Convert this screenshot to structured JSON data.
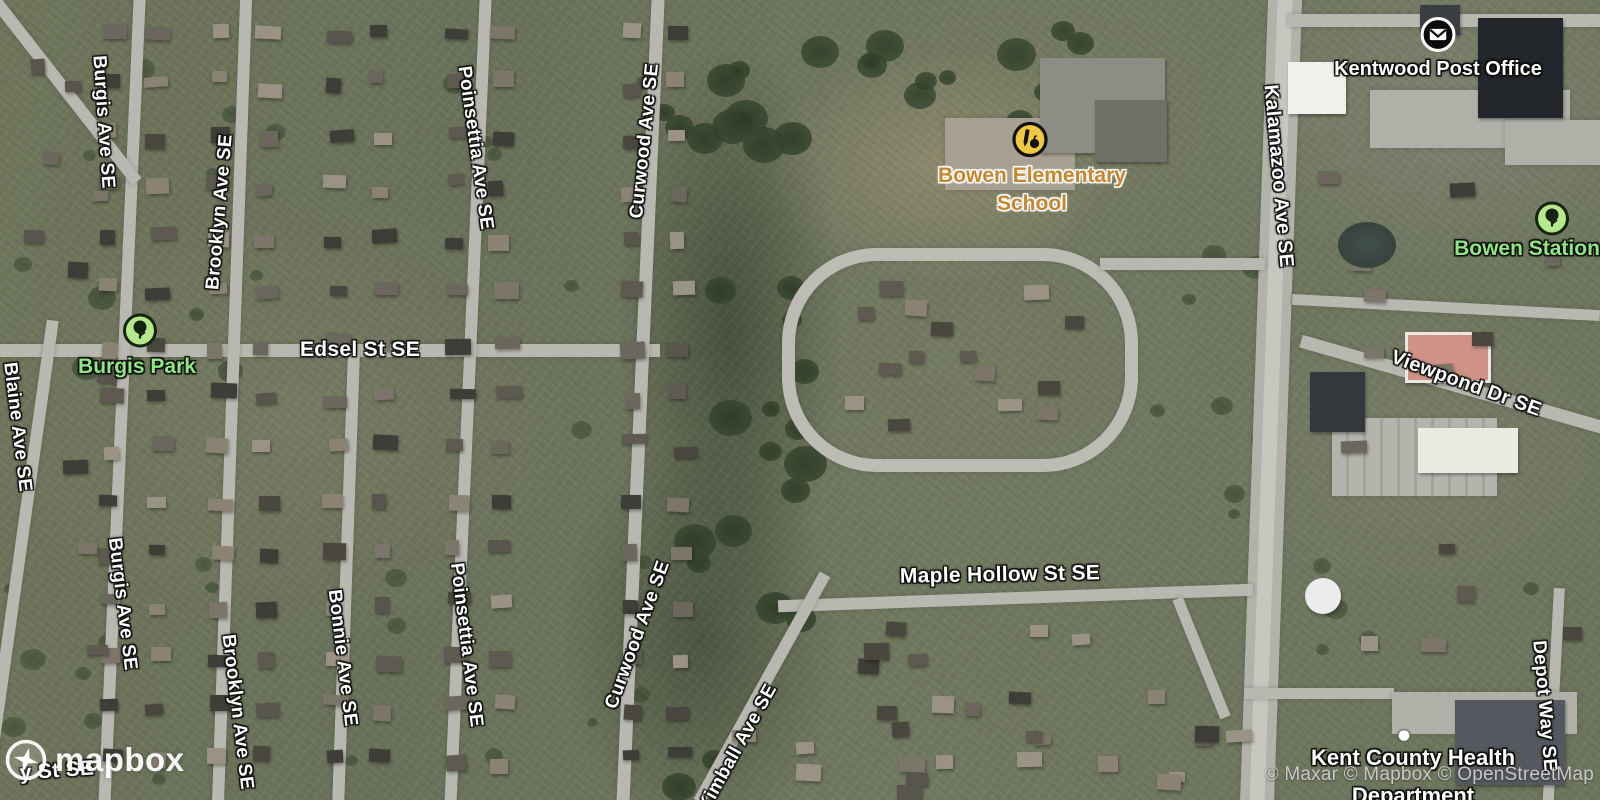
{
  "map": {
    "attribution": "© Maxar © Mapbox © OpenStreetMap",
    "logo_text": "mapbox",
    "colors": {
      "street_label": "#ffffff",
      "park_label": "#8fe683",
      "school_label": "#c6862f",
      "poi_label": "#ffffff",
      "attribution": "#c9c9c9"
    },
    "street_labels": [
      {
        "text": "Burgis Ave SE",
        "x": 103,
        "y": 122,
        "rot": 86,
        "size": 19
      },
      {
        "text": "Brooklyn Ave SE",
        "x": 220,
        "y": 212,
        "rot": -85,
        "size": 19
      },
      {
        "text": "Poinsettia Ave SE",
        "x": 475,
        "y": 148,
        "rot": 82,
        "size": 19
      },
      {
        "text": "Curwood Ave SE",
        "x": 645,
        "y": 141,
        "rot": -84,
        "size": 19
      },
      {
        "text": "Kalamazoo Ave SE",
        "x": 1278,
        "y": 176,
        "rot": 85,
        "size": 20
      },
      {
        "text": "Blaine Ave SE",
        "x": 17,
        "y": 427,
        "rot": 83,
        "size": 19
      },
      {
        "text": "Edsel St SE",
        "x": 360,
        "y": 350,
        "rot": 0,
        "size": 21
      },
      {
        "text": "Burgis Ave SE",
        "x": 122,
        "y": 604,
        "rot": 83,
        "size": 19
      },
      {
        "text": "Brooklyn Ave SE",
        "x": 237,
        "y": 712,
        "rot": 83,
        "size": 19
      },
      {
        "text": "Bonnie Ave SE",
        "x": 342,
        "y": 658,
        "rot": 83,
        "size": 19
      },
      {
        "text": "Poinsettia Ave SE",
        "x": 466,
        "y": 645,
        "rot": 83,
        "size": 19
      },
      {
        "text": "Curwood Ave SE",
        "x": 638,
        "y": 635,
        "rot": -70,
        "size": 19
      },
      {
        "text": "Kimball Ave SE",
        "x": 738,
        "y": 748,
        "rot": -61,
        "size": 19
      },
      {
        "text": "Viewpond Dr SE",
        "x": 1466,
        "y": 384,
        "rot": 20,
        "size": 20
      },
      {
        "text": "Maple Hollow St SE",
        "x": 1000,
        "y": 575,
        "rot": -1,
        "size": 21
      },
      {
        "text": "Depot Way SE",
        "x": 1544,
        "y": 706,
        "rot": 85,
        "size": 19
      },
      {
        "text": "y St SE",
        "x": 57,
        "y": 771,
        "rot": -4,
        "size": 21
      }
    ],
    "poi_labels": [
      {
        "name": "kentwood-post-office",
        "lines": [
          "Kentwood Post Office"
        ],
        "style": "white",
        "icon": "post-office-icon",
        "icon_x": 1438,
        "icon_y": 37,
        "x": 1438,
        "y": 56,
        "size": 20,
        "lh": 26
      },
      {
        "name": "bowen-elementary-school",
        "lines": [
          "Bowen Elementary",
          "School"
        ],
        "style": "school",
        "icon": "school-icon",
        "icon_x": 1030,
        "icon_y": 142,
        "x": 1032,
        "y": 162,
        "size": 21,
        "lh": 28
      },
      {
        "name": "burgis-park",
        "lines": [
          "Burgis Park"
        ],
        "style": "park",
        "icon": "tree-icon",
        "icon_x": 140,
        "icon_y": 333,
        "x": 137,
        "y": 354,
        "size": 21,
        "lh": 26
      },
      {
        "name": "bowen-station",
        "lines": [
          "Bowen Station"
        ],
        "style": "park",
        "icon": "tree-icon",
        "icon_x": 1552,
        "icon_y": 221,
        "x": 1527,
        "y": 236,
        "size": 21,
        "lh": 26
      },
      {
        "name": "kent-county-health",
        "lines": [
          "Kent County Health",
          "Department"
        ],
        "style": "white",
        "icon": "dot-icon",
        "icon_x": 1404,
        "icon_y": 738,
        "x": 1413,
        "y": 739,
        "size": 22,
        "lh": 38
      }
    ]
  }
}
